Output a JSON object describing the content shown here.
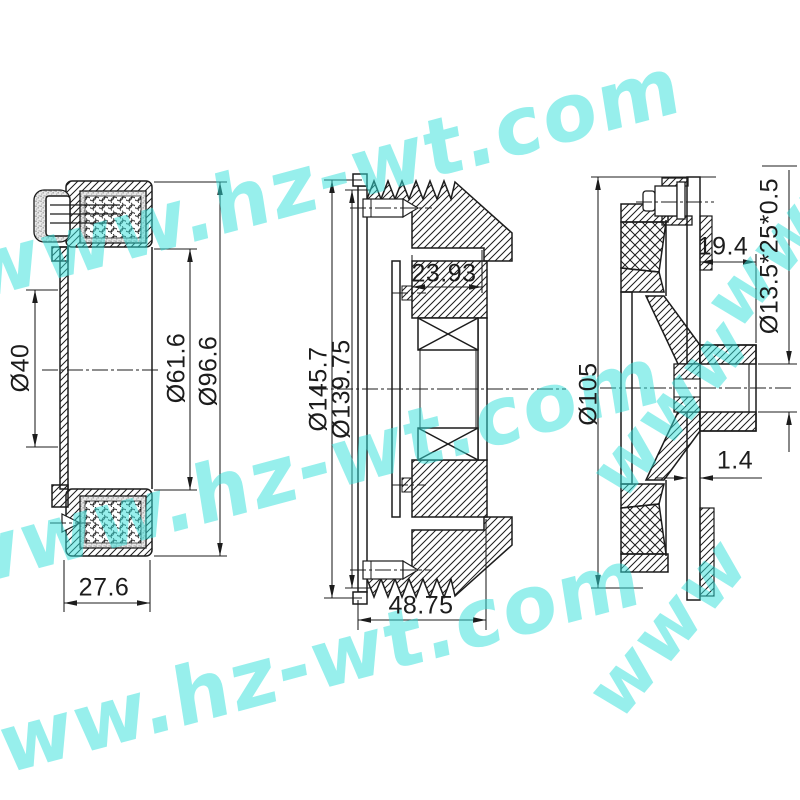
{
  "drawing": {
    "background": "#ffffff",
    "line_color": "#1c1c1c",
    "views": {
      "coil": {
        "bore_diameter": "Ø40",
        "inner_diameter": "Ø61.6",
        "outer_diameter": "Ø96.6",
        "width": "27.6"
      },
      "pulley": {
        "outer_diameter": "Ø145.7",
        "groove_diameter": "Ø139.75",
        "hub_depth": "23.93",
        "total_width": "48.75"
      },
      "plate": {
        "outer_diameter": "Ø105",
        "hub_length": "19.4",
        "bearing_spec": "Ø13.5*25*0.5",
        "plate_thickness": "1.4"
      }
    }
  },
  "watermark": {
    "text": "www.hz-wt.com",
    "fragment": "www",
    "color": "#2fe0da"
  }
}
